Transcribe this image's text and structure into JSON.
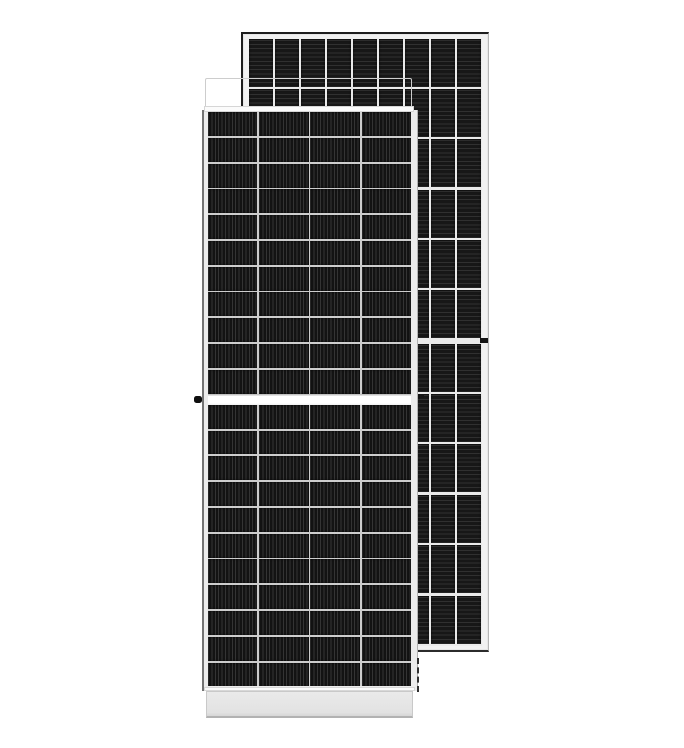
{
  "scene": {
    "description": "Product photo of two overlapping framed monocrystalline half-cut solar panels on a plain white background",
    "background_color": "#ffffff"
  },
  "colors": {
    "cell_dark": "#131313",
    "front_gap": "#cdcdcd",
    "back_gap": "#eaeaea",
    "frame_face": "#f1f1f1",
    "lip_white": "#fbfbfb",
    "edge_gray": "#b5b5b5",
    "dark_border": "#1d1d1d",
    "hardware_black": "#0f0f0f"
  },
  "front_panel": {
    "label": "front solar panel, rotated orientation",
    "columns": 4,
    "rows_top": 11,
    "rows_bottom": 11,
    "cell_texture": "vertical-stripes",
    "features": [
      "white top frame cap",
      "white bottom frame cap",
      "bright center split gap",
      "black grounding knob on left frame"
    ]
  },
  "back_panel": {
    "label": "rear solar panel, upright orientation",
    "columns": 9,
    "rows": 12,
    "split_after_row": 6,
    "cell_texture": "horizontal-stripes",
    "features": [
      "dark outer border on top and left",
      "black clip on right frame at center split",
      "dashed edge near lower right of front panel"
    ]
  },
  "layout_params": {
    "back_row_height": 48,
    "back_row_gap": 2.4,
    "back_split_extra": 2.8,
    "back_col_gap": 1.7,
    "front_row_height": 23.95,
    "front_row_gap": 1.85,
    "front_col_gap": 1.7
  }
}
